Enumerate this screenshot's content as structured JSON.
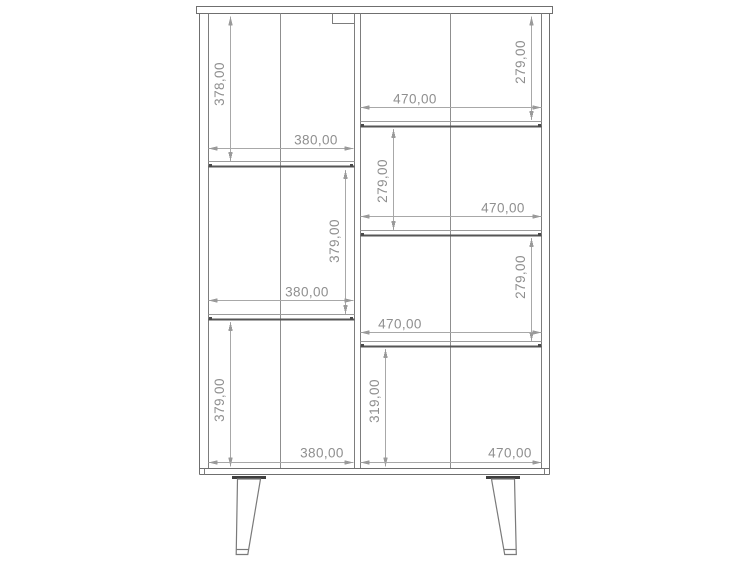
{
  "drawing": {
    "description": "Front elevation technical drawing of a two-column shelving cabinet on splayed tapered legs",
    "units": "mm",
    "columns": {
      "left": {
        "inner_width": "380,00",
        "compartment_heights": [
          "378,00",
          "379,00",
          "379,00"
        ]
      },
      "right": {
        "inner_width": "470,00",
        "compartment_heights": [
          "279,00",
          "279,00",
          "279,00",
          "319,00"
        ]
      }
    },
    "annotations": {
      "d1": "378,00",
      "d2": "380,00",
      "d3": "379,00",
      "d4": "380,00",
      "d5": "379,00",
      "d6": "380,00",
      "d7": "279,00",
      "d8": "470,00",
      "d9": "279,00",
      "d10": "470,00",
      "d11": "279,00",
      "d12": "470,00",
      "d13": "319,00",
      "d14": "470,00"
    },
    "colors": {
      "background": "#ffffff",
      "outline": "#6f6f6f",
      "shelf_edge": "#555555",
      "dimension_line": "#a8a8a8",
      "dimension_text": "#8f8f8f"
    }
  }
}
